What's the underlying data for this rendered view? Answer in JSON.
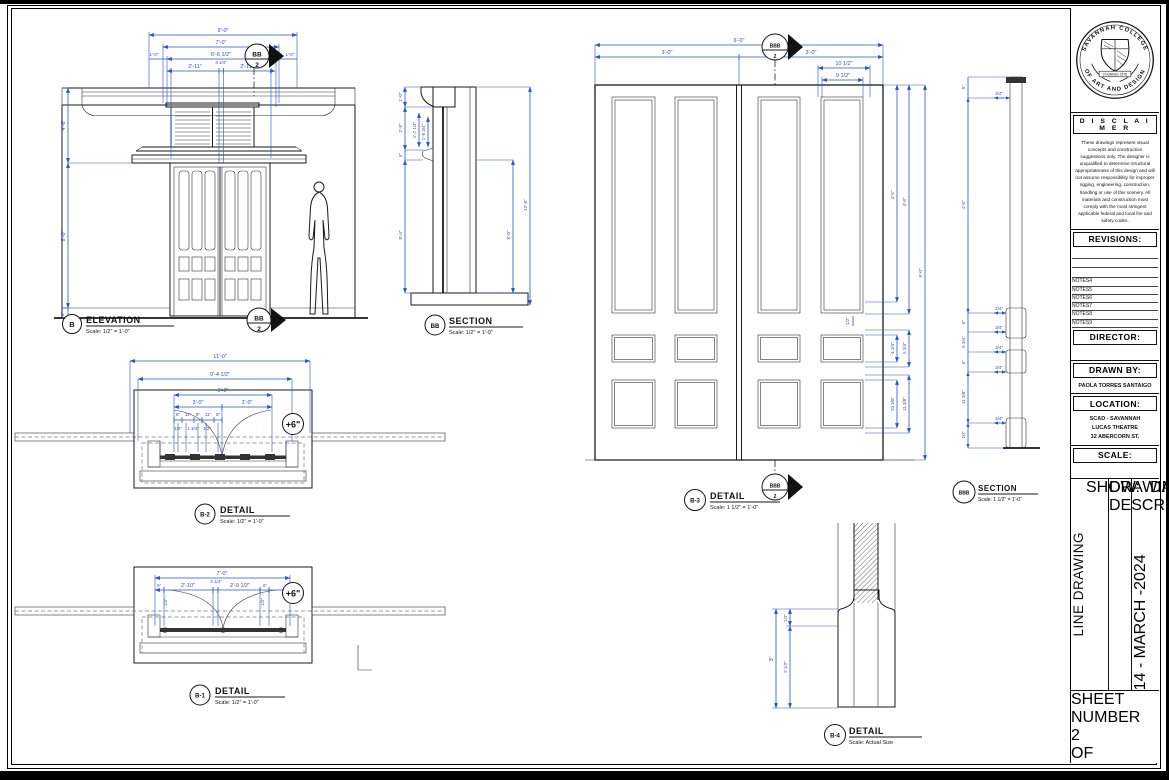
{
  "views": {
    "elevation_b": {
      "dims": {
        "w90": "9'-0\"",
        "w70": "7'-0\"",
        "w6612": "6'-6 1/2\"",
        "ft1l": "1'-0\"",
        "ft1r": "1'-0\"",
        "d211a": "2'-11\"",
        "d314": "3 1/4\"",
        "d211b": "2'-11\"",
        "h46": "4'-6\"",
        "h80": "8'-0\"",
        "h6": "6\""
      },
      "marker": {
        "top": "BB",
        "top_num": "2",
        "bottom": "BB",
        "bottom_num": "2"
      },
      "label": {
        "bubble": "B",
        "title": "ELEVATION",
        "scale": "Scale: 1/2\" = 1'-0\""
      }
    },
    "section_bb": {
      "dims": {
        "h10": "1'-0\"",
        "h28": "2'-8\"",
        "h1714": "1'-7 1/4\"",
        "h1634": "1'-6 3/4\"",
        "h5": "5\"",
        "h84": "8'-4\"",
        "h126": "12'-6\"",
        "h80": "8'-0\""
      },
      "label": {
        "bubble": "BB",
        "title": "SECTION",
        "scale": "Scale: 1/2\" = 1'-0\""
      }
    },
    "detail_b2": {
      "dims": {
        "w110": "11'-0\"",
        "w9412": "9'-4 1/2\"",
        "w60": "6'-0\"",
        "w30a": "3'-0\"",
        "w30b": "3'-0\"",
        "s8a": "8\"",
        "s11a": "11\"",
        "s8b": "8\"",
        "s11b": "11\"",
        "s8c": "8\"",
        "t12a": "1/2\"",
        "t134": "1 3/4\"",
        "t12b": "1/2\""
      },
      "plus6": "+6\"",
      "label": {
        "bubble": "B-2",
        "title": "DETAIL",
        "scale": "Scale: 1/2\" = 1'-0\""
      }
    },
    "detail_b1": {
      "dims": {
        "w70": "7'-0\"",
        "s6a": "6\"",
        "w210": "2'-10\"",
        "w314": "3 1/4\"",
        "w2912": "2'-9 1/2\"",
        "s6b": "6\"",
        "t12a": "1/2\"",
        "t12b": "1/2\""
      },
      "plus6": "+6\"",
      "label": {
        "bubble": "B-1",
        "title": "DETAIL",
        "scale": "Scale: 1/2\" = 1'-0\""
      }
    },
    "detail_b3": {
      "dims": {
        "w60": "6'-0\"",
        "w30a": "3'-0\"",
        "w30b": "3'-0\"",
        "w1012": "10 1/2\"",
        "w912": "9 1/2\"",
        "h45": "4'-5\"",
        "h48": "4'-8\"",
        "h80": "8'-0\"",
        "h434": "4 3/4\"",
        "h534": "5 3/4\"",
        "h1038": "10 3/8\"",
        "h1138": "11 3/8\"",
        "h12": "1/2\""
      },
      "marker": {
        "id": "BBB",
        "num": "2"
      },
      "label": {
        "bubble": "B-3",
        "title": "DETAIL",
        "scale": "Scale: 1 1/2\" = 1'-0\""
      }
    },
    "section_bbb": {
      "dims": {
        "s5a": "5\"",
        "h46": "4'-6\"",
        "s5b": "5\"",
        "s534": "5 3/4\"",
        "s5c": "5\"",
        "s1138": "11 3/8\"",
        "s10": "10\"",
        "t34": "3/4\""
      },
      "label": {
        "bubble": "BBB",
        "title": "SECTION",
        "scale": "Scale: 1 1/2\" = 1'-0\""
      }
    },
    "detail_b4": {
      "dims": {
        "h3": "3\"",
        "h12": "1/2\"",
        "h212": "2 1/2\""
      },
      "label": {
        "bubble": "B-4",
        "title": "DETAIL",
        "scale": "Scale: Actual Size"
      }
    }
  },
  "titleblock": {
    "seal": {
      "text_top": "SAVANNAH COLLEGE",
      "text_bottom": "OF ART AND DESIGN",
      "banner": "FOUNDED 1978"
    },
    "disclaimer": {
      "title": "D I S C L A I M E R",
      "body": "These drawings represent visual concepts and construction suggestions only.  The designer is unqualified to determine structural appropriateness of this design and will not assume responsibility for improper rigging, engineering, construction, handling or use of this scenery.  All materials and construction must comply with the most stringent applicable federal and local fire and safety codes."
    },
    "revisions": {
      "title": "REVISIONS:",
      "notes": [
        "NOTES4",
        "NOTES5",
        "NOTES6",
        "NOTES7",
        "NOTES8",
        "NOTES9"
      ]
    },
    "director": {
      "title": "DIRECTOR:"
    },
    "drawn_by": {
      "title": "DRAWN BY:",
      "value": "PAOLA TORRES SANTAIGO"
    },
    "location": {
      "title": "LOCATION:",
      "lines": [
        "SCAD - SAVANNAH",
        "LUCAS THEATRE",
        "32 ABERCORN ST."
      ]
    },
    "scale": {
      "title": "SCALE:"
    },
    "strip": {
      "show_label": "SHOW:",
      "show_value": "LINE DRAWING",
      "desc_label": "DRAWING DESCRIPTION:",
      "date_label": "DATE:",
      "date_value": "14 - MARCH -2024"
    },
    "sheet": {
      "line1": "SHEET",
      "line2": "NUMBER",
      "number": "2",
      "of": "OF"
    }
  }
}
